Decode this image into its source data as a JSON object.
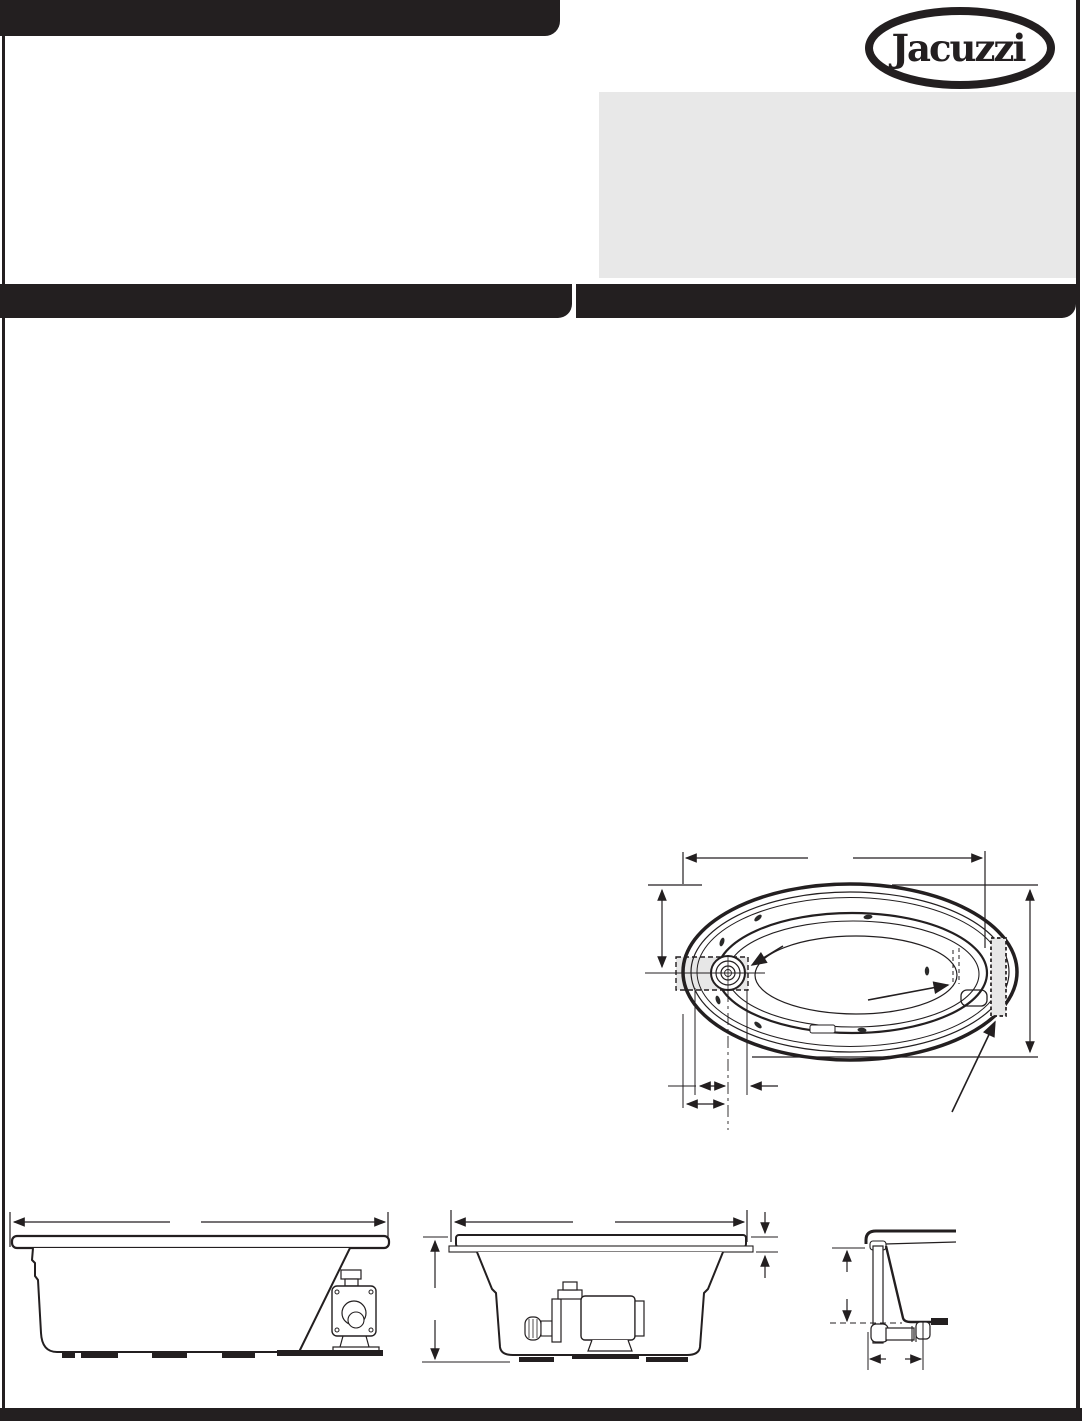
{
  "brand": {
    "name": "Jacuzzi",
    "registered_mark": "®"
  },
  "colors": {
    "ink": "#231f20",
    "panel_gray": "#e8e8e8",
    "paper": "#ffffff",
    "drawing_fill_gray": "#e7e7e7"
  },
  "drawings": {
    "top_view": "bathtub-top-view",
    "side_view": "bathtub-side-elevation-with-pump",
    "end_view": "bathtub-end-elevation-with-pump",
    "corner_detail": "drain-overflow-piping-detail"
  }
}
